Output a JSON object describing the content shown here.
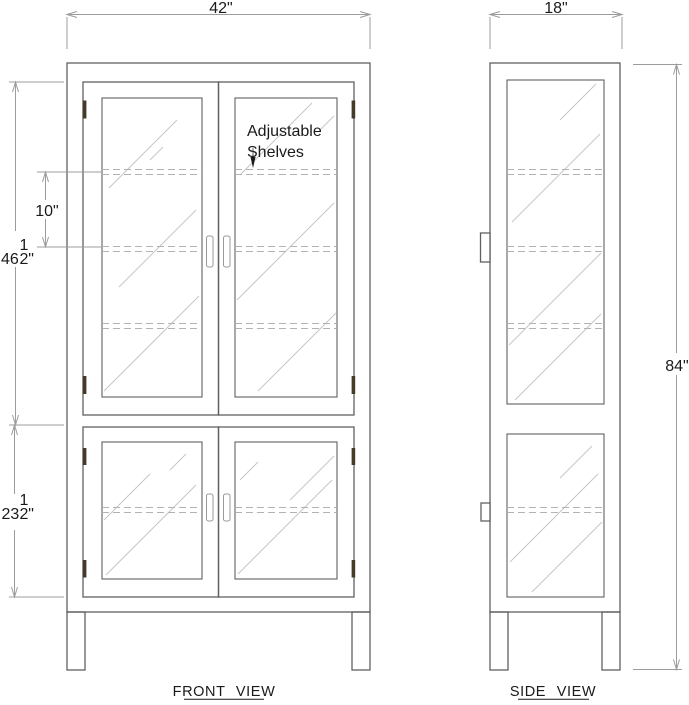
{
  "colors": {
    "background": "#ffffff",
    "line": "#606060",
    "glass_line": "#c6c6c6",
    "hidden_line": "#b2b2b2",
    "dimension": "#9c9c9c",
    "text": "#1a1a1a",
    "hinge": "#453a28",
    "handle": "#9a9a9a"
  },
  "front_view": {
    "title": "FRONT VIEW",
    "annotation": {
      "line1": "Adjustable",
      "line2": "Shelves"
    },
    "dims": {
      "width": "42\"",
      "shelf_spacing": "10\"",
      "upper_height": {
        "whole": "46",
        "numerator": "1",
        "denominator": "2",
        "unit": "\""
      },
      "lower_height": {
        "whole": "23",
        "numerator": "1",
        "denominator": "2",
        "unit": "\""
      }
    }
  },
  "side_view": {
    "title": "SIDE VIEW",
    "dims": {
      "depth": "18\"",
      "height": "84\""
    }
  }
}
